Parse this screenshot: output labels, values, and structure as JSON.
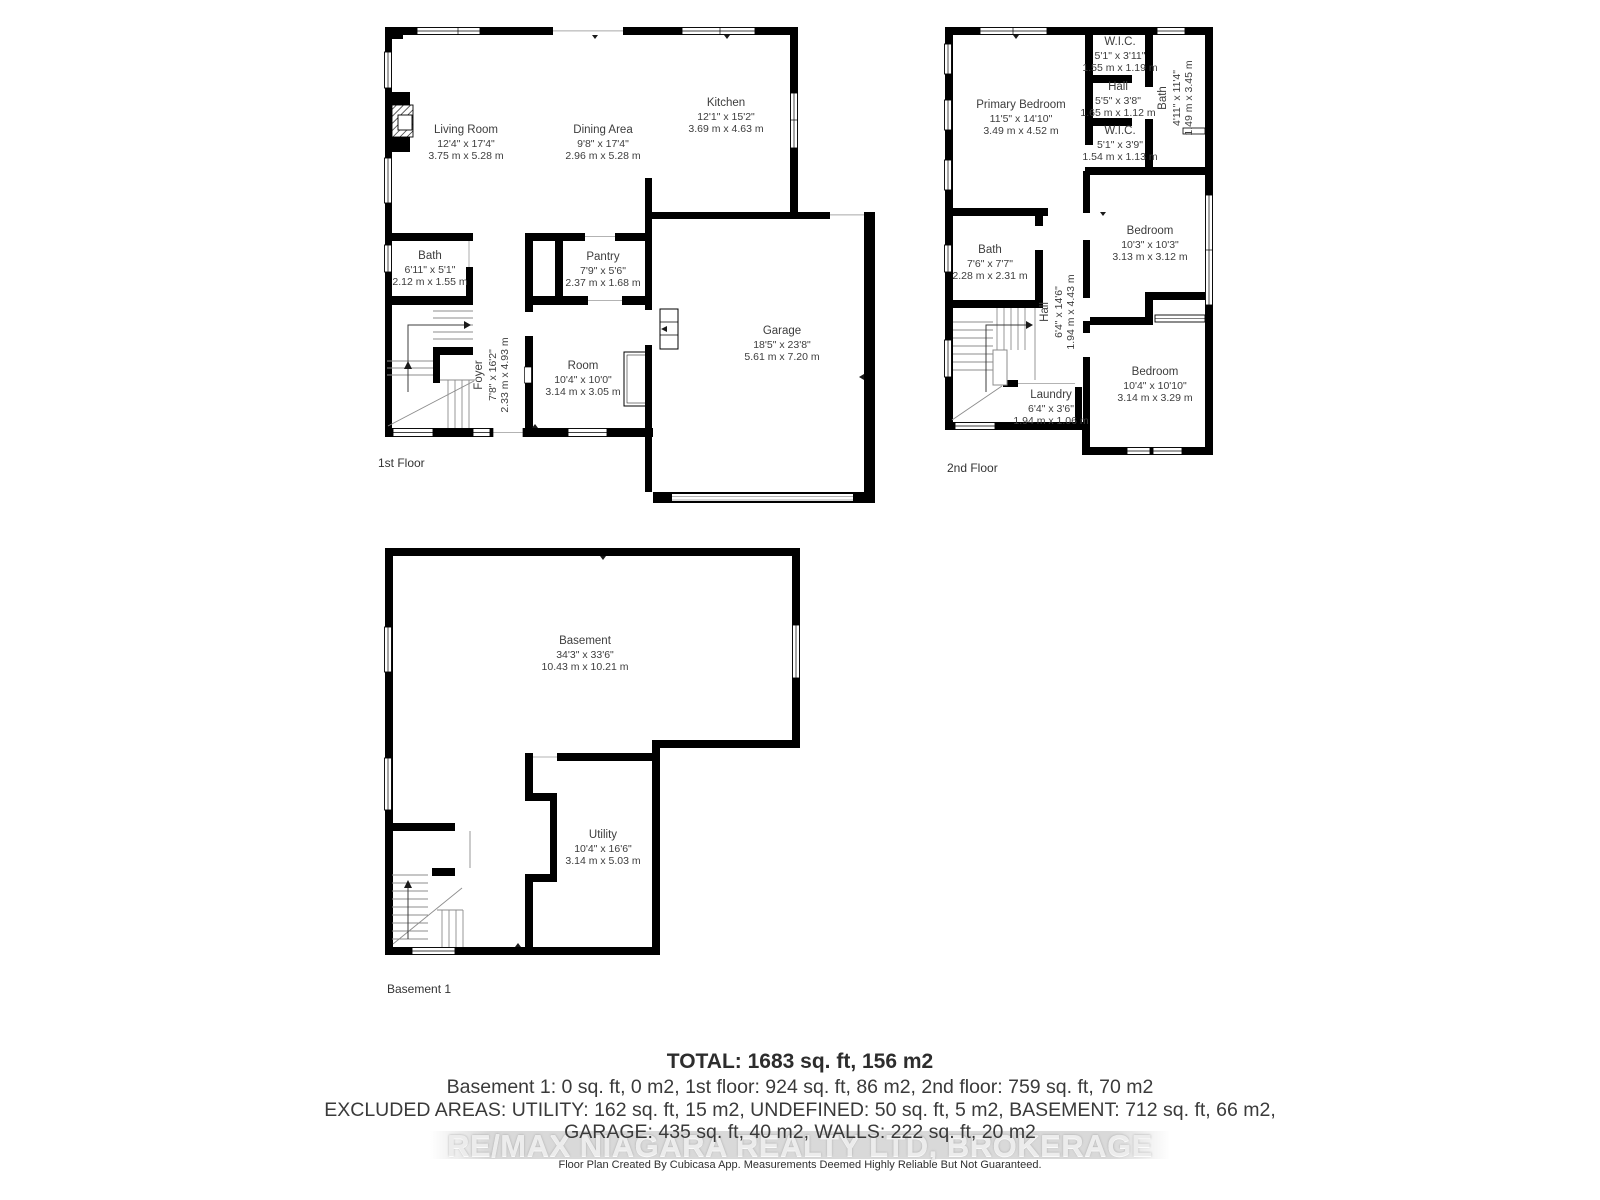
{
  "colors": {
    "wall": "#000000",
    "label_text": "#3d3d3d",
    "summary_text": "#3a3a3a",
    "watermark_text": "#ececec"
  },
  "floors": [
    {
      "label": "1st Floor",
      "rooms": [
        {
          "name": "Living Room",
          "imperial": "12'4\" x 17'4\"",
          "metric": "3.75 m x 5.28 m"
        },
        {
          "name": "Dining Area",
          "imperial": "9'8\" x 17'4\"",
          "metric": "2.96 m x 5.28 m"
        },
        {
          "name": "Kitchen",
          "imperial": "12'1\" x 15'2\"",
          "metric": "3.69 m x 4.63 m"
        },
        {
          "name": "Bath",
          "imperial": "6'11\" x 5'1\"",
          "metric": "2.12 m x 1.55 m"
        },
        {
          "name": "Pantry",
          "imperial": "7'9\" x 5'6\"",
          "metric": "2.37 m x 1.68 m"
        },
        {
          "name": "Foyer",
          "imperial": "7'8\" x 16'2\"",
          "metric": "2.33 m x 4.93 m"
        },
        {
          "name": "Room",
          "imperial": "10'4\" x 10'0\"",
          "metric": "3.14 m x 3.05 m"
        },
        {
          "name": "Garage",
          "imperial": "18'5\" x 23'8\"",
          "metric": "5.61 m x 7.20 m"
        }
      ]
    },
    {
      "label": "2nd Floor",
      "rooms": [
        {
          "name": "Primary Bedroom",
          "imperial": "11'5\" x 14'10\"",
          "metric": "3.49 m x 4.52 m"
        },
        {
          "name": "W.I.C.",
          "imperial": "5'1\" x 3'11\"",
          "metric": "1.55 m x 1.19 m"
        },
        {
          "name": "Hall",
          "imperial": "5'5\" x 3'8\"",
          "metric": "1.65 m x 1.12 m"
        },
        {
          "name": "W.I.C.",
          "imperial": "5'1\" x 3'9\"",
          "metric": "1.54 m x 1.13 m"
        },
        {
          "name": "Bath",
          "imperial": "4'11\" x 11'4\"",
          "metric": "1.49 m x 3.45 m"
        },
        {
          "name": "Bath",
          "imperial": "7'6\" x 7'7\"",
          "metric": "2.28 m x 2.31 m"
        },
        {
          "name": "Hall",
          "imperial": "6'4\" x 14'6\"",
          "metric": "1.94 m x 4.43 m"
        },
        {
          "name": "Bedroom",
          "imperial": "10'3\" x 10'3\"",
          "metric": "3.13 m x 3.12 m"
        },
        {
          "name": "Bedroom",
          "imperial": "10'4\" x 10'10\"",
          "metric": "3.14 m x 3.29 m"
        },
        {
          "name": "Laundry",
          "imperial": "6'4\" x 3'6\"",
          "metric": "1.94 m x 1.06 m"
        }
      ]
    },
    {
      "label": "Basement 1",
      "rooms": [
        {
          "name": "Basement",
          "imperial": "34'3\" x 33'6\"",
          "metric": "10.43 m x 10.21 m"
        },
        {
          "name": "Utility",
          "imperial": "10'4\" x 16'6\"",
          "metric": "3.14 m x 5.03 m"
        }
      ]
    }
  ],
  "summary": {
    "total": "TOTAL: 1683 sq. ft, 156 m2",
    "line1": "Basement 1: 0 sq. ft, 0 m2, 1st floor: 924 sq. ft, 86 m2, 2nd floor: 759 sq. ft, 70 m2",
    "line2": "EXCLUDED AREAS: UTILITY: 162 sq. ft, 15 m2, UNDEFINED: 50 sq. ft, 5 m2, BASEMENT: 712 sq. ft, 66 m2,",
    "line3": "GARAGE: 435 sq. ft, 40 m2, WALLS: 222 sq. ft, 20 m2"
  },
  "watermark": "RE/MAX NIAGARA REALTY LTD, BROKERAGE",
  "disclaimer": "Floor Plan Created By Cubicasa App. Measurements Deemed Highly Reliable But Not Guaranteed."
}
